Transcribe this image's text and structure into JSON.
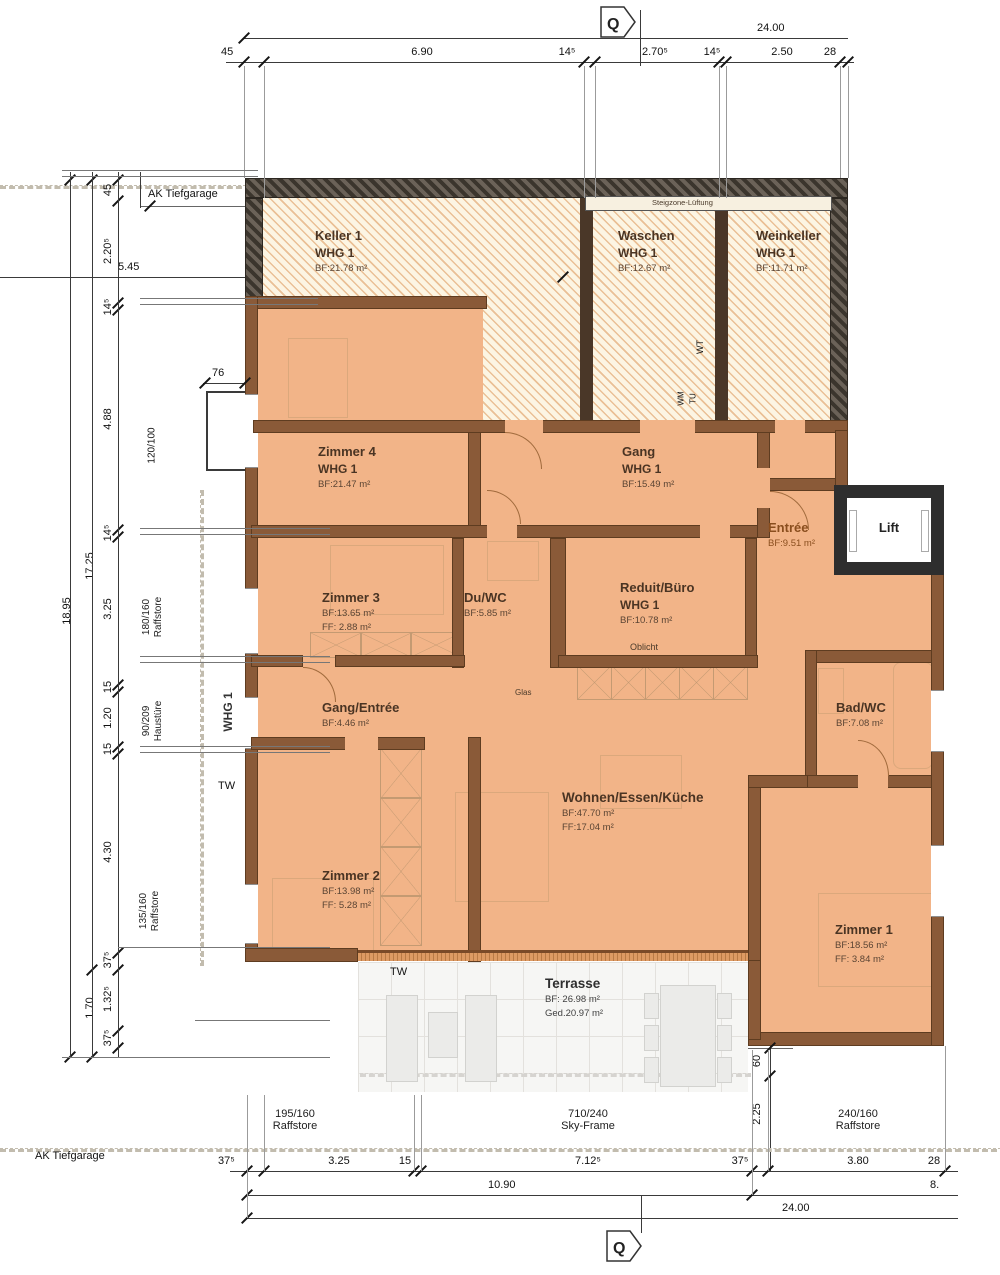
{
  "markers": {
    "q_top": "Q",
    "q_bottom": "Q"
  },
  "labels": {
    "ak_top": "AK Tiefgarage",
    "ak_bottom": "AK Tiefgarage",
    "whg_vertical": "WHG 1",
    "tw_left": "TW",
    "tw_terrace": "TW",
    "glas": "Glas",
    "oblicht": "Oblicht",
    "steigzone": "Steigzone-Lüftung",
    "wt": "WT",
    "wm": "WM",
    "tu": "TU"
  },
  "rooms": {
    "keller": {
      "name": "Keller 1",
      "whg": "WHG 1",
      "bf": "BF:21.78 m²"
    },
    "waschen": {
      "name": "Waschen",
      "whg": "WHG 1",
      "bf": "BF:12.67 m²"
    },
    "weinkeller": {
      "name": "Weinkeller",
      "whg": "WHG 1",
      "bf": "BF:11.71 m²"
    },
    "zimmer4": {
      "name": "Zimmer 4",
      "whg": "WHG 1",
      "bf": "BF:21.47 m²"
    },
    "gang": {
      "name": "Gang",
      "whg": "WHG 1",
      "bf": "BF:15.49 m²"
    },
    "entree": {
      "name": "Entrée",
      "bf": "BF:9.51 m²"
    },
    "lift": {
      "name": "Lift"
    },
    "zimmer3": {
      "name": "Zimmer 3",
      "bf": "BF:13.65 m²",
      "ff": "FF:  2.88 m²"
    },
    "duwc": {
      "name": "Du/WC",
      "bf": "BF:5.85 m²"
    },
    "reduit": {
      "name": "Reduit/Büro",
      "whg": "WHG 1",
      "bf": "BF:10.78 m²"
    },
    "gang_entree": {
      "name": "Gang/Entrée",
      "bf": "BF:4.46 m²"
    },
    "badwc": {
      "name": "Bad/WC",
      "bf": "BF:7.08 m²"
    },
    "wohnen": {
      "name": "Wohnen/Essen/Küche",
      "bf": "BF:47.70 m²",
      "ff": "FF:17.04 m²"
    },
    "zimmer2": {
      "name": "Zimmer 2",
      "bf": "BF:13.98 m²",
      "ff": "FF:  5.28 m²"
    },
    "zimmer1": {
      "name": "Zimmer 1",
      "bf": "BF:18.56 m²",
      "ff": "FF:  3.84 m²"
    },
    "terrasse": {
      "name": "Terrasse",
      "bf": "BF:  26.98 m²",
      "ged": "Ged.20.97 m²"
    }
  },
  "dims": {
    "top": {
      "total": "24.00",
      "segs": [
        "45",
        "6.90",
        "14⁵",
        "2.70⁵",
        "14⁵",
        "2.50",
        "28"
      ]
    },
    "bottom": {
      "segs": [
        "37⁵",
        "3.25",
        "15",
        "7.12⁵",
        "37⁵",
        "3.80",
        "28"
      ],
      "sub_left": "10.90",
      "sub_right": "8.",
      "total": "24.00",
      "op1": {
        "size": "195/160",
        "type": "Raffstore"
      },
      "op2": {
        "size": "710/240",
        "type": "Sky-Frame"
      },
      "op3": {
        "size": "240/160",
        "type": "Raffstore"
      }
    },
    "left": {
      "v45": "45",
      "v220": "2.20⁵",
      "h545": "5.45",
      "v145a": "14⁵",
      "v488": "4.88",
      "w120": "120/100",
      "h76": "76",
      "v145b": "14⁵",
      "v1725": "17.25",
      "v1895": "18.95",
      "v325": "3.25",
      "r180": "180/160",
      "r180b": "Raffstore",
      "v15a": "15",
      "v120": "1.20",
      "h90": "90/209",
      "h90b": "Haustüre",
      "v15b": "15",
      "v430": "4.30",
      "r135": "135/160",
      "r135b": "Raffstore",
      "v375a": "37⁵",
      "v170": "1.70",
      "v1325": "1.32⁵",
      "v375b": "37⁵"
    },
    "right": {
      "v60": "60",
      "v225": "2.25"
    }
  },
  "colors": {
    "floor": "#f2b488",
    "wall": "#8a5a38",
    "basement": "#fcf5e3",
    "garage_wall": "#3b352d",
    "lift_wall": "#2e2e2e",
    "room_text": "#4a3423",
    "entree_text": "#8a4e1e"
  }
}
